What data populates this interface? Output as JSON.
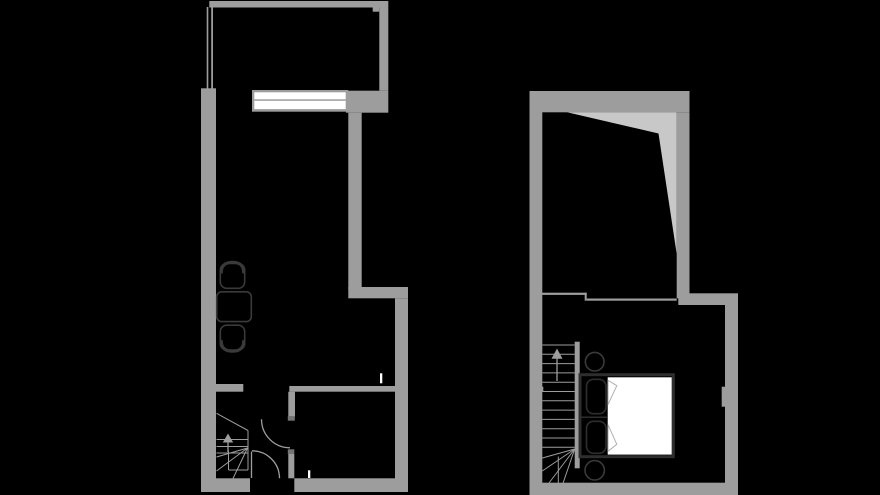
{
  "figure": {
    "type": "floor-plan",
    "description": "Two-panel black-background architectural floor plan; left panel lower level with terrace, window unit, dining set, winder stair and doors; right panel upper level with roof-slope area, winder stair and bedroom",
    "visible_text": [],
    "panels": [
      {
        "id": "floor-plan-left",
        "rooms": [
          "terrace",
          "living-room",
          "hallway",
          "bathroom"
        ],
        "objects": [
          "window-unit",
          "dining-table",
          "dining-chair-top",
          "dining-chair-bottom",
          "staircase",
          "up-arrow",
          "room-door",
          "entry-door"
        ]
      },
      {
        "id": "floor-plan-right",
        "rooms": [
          "loft-room",
          "bedroom"
        ],
        "objects": [
          "roof-slope-area",
          "railing-divider",
          "staircase",
          "up-arrow",
          "double-bed",
          "pillow-top",
          "pillow-bottom",
          "mattress",
          "bedside-table-top",
          "bedside-table-bottom"
        ]
      }
    ]
  },
  "colors": {
    "background": "#000000",
    "wall": "#9d9d9d",
    "wall_light": "#c8c8c8",
    "line": "#9d9d9d",
    "jamb": "#757575",
    "furniture_outline": "#3a3a3a",
    "bed_frame": "#2e2e2e",
    "fold_line": "#b0b0b0",
    "white": "#ffffff"
  },
  "canvas": {
    "width": 880,
    "height": 495
  }
}
